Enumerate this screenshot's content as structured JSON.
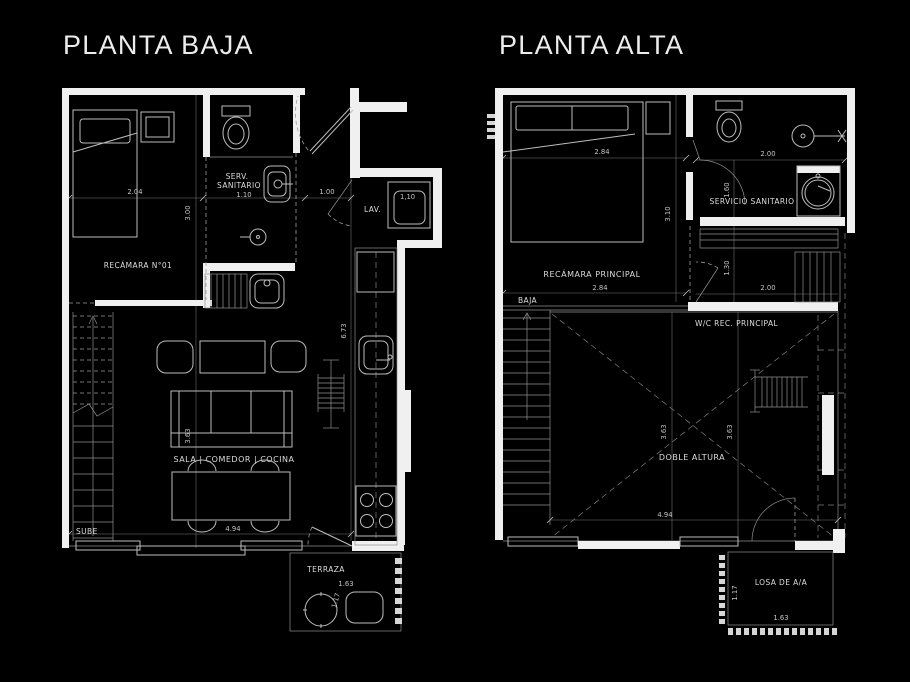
{
  "canvas": {
    "background_color": "#000000",
    "wall_color": "#f0f0f0",
    "line_color": "#bdbdbd",
    "text_color": "#dcdcdc"
  },
  "planta_baja": {
    "title": "PLANTA BAJA",
    "labels": {
      "recamara": "RECÁMARA N°01",
      "serv_line1": "SERV.",
      "serv_line2": "SANITARIO",
      "serv_dim": "1.10",
      "lav": "LAV.",
      "lav_dim": "1,10",
      "sala": "SALA | COMEDOR | COCINA",
      "sube": "SUBE",
      "terraza": "TERRAZA"
    },
    "dimensions": {
      "recamara_width": "2.04",
      "recamara_depth": "3.00",
      "entry_width": "1.00",
      "corridor_length": "6.73",
      "sala_depth": "3.63",
      "sala_width": "4.94",
      "terraza_width": "1.63",
      "terraza_depth": "1.17"
    }
  },
  "planta_alta": {
    "title": "PLANTA ALTA",
    "labels": {
      "recamara_principal": "RECÁMARA PRINCIPAL",
      "servicio_sanitario": "SERVICIO SANITARIO",
      "wc_principal": "W/C REC. PRINCIPAL",
      "baja": "BAJA",
      "doble_altura": "DOBLE ALTURA",
      "losa": "LOSA DE A/A"
    },
    "dimensions": {
      "bed_width_top": "2.84",
      "recamara_depth": "3.10",
      "bed_width_bottom": "2.84",
      "bath_depth": "1.60",
      "bath_width": "2.00",
      "closet_depth": "1.30",
      "wc_width": "2.00",
      "void_depth_left": "3.63",
      "void_depth_right": "3.63",
      "void_width": "4.94",
      "losa_depth": "1.17",
      "losa_width": "1.63"
    }
  }
}
